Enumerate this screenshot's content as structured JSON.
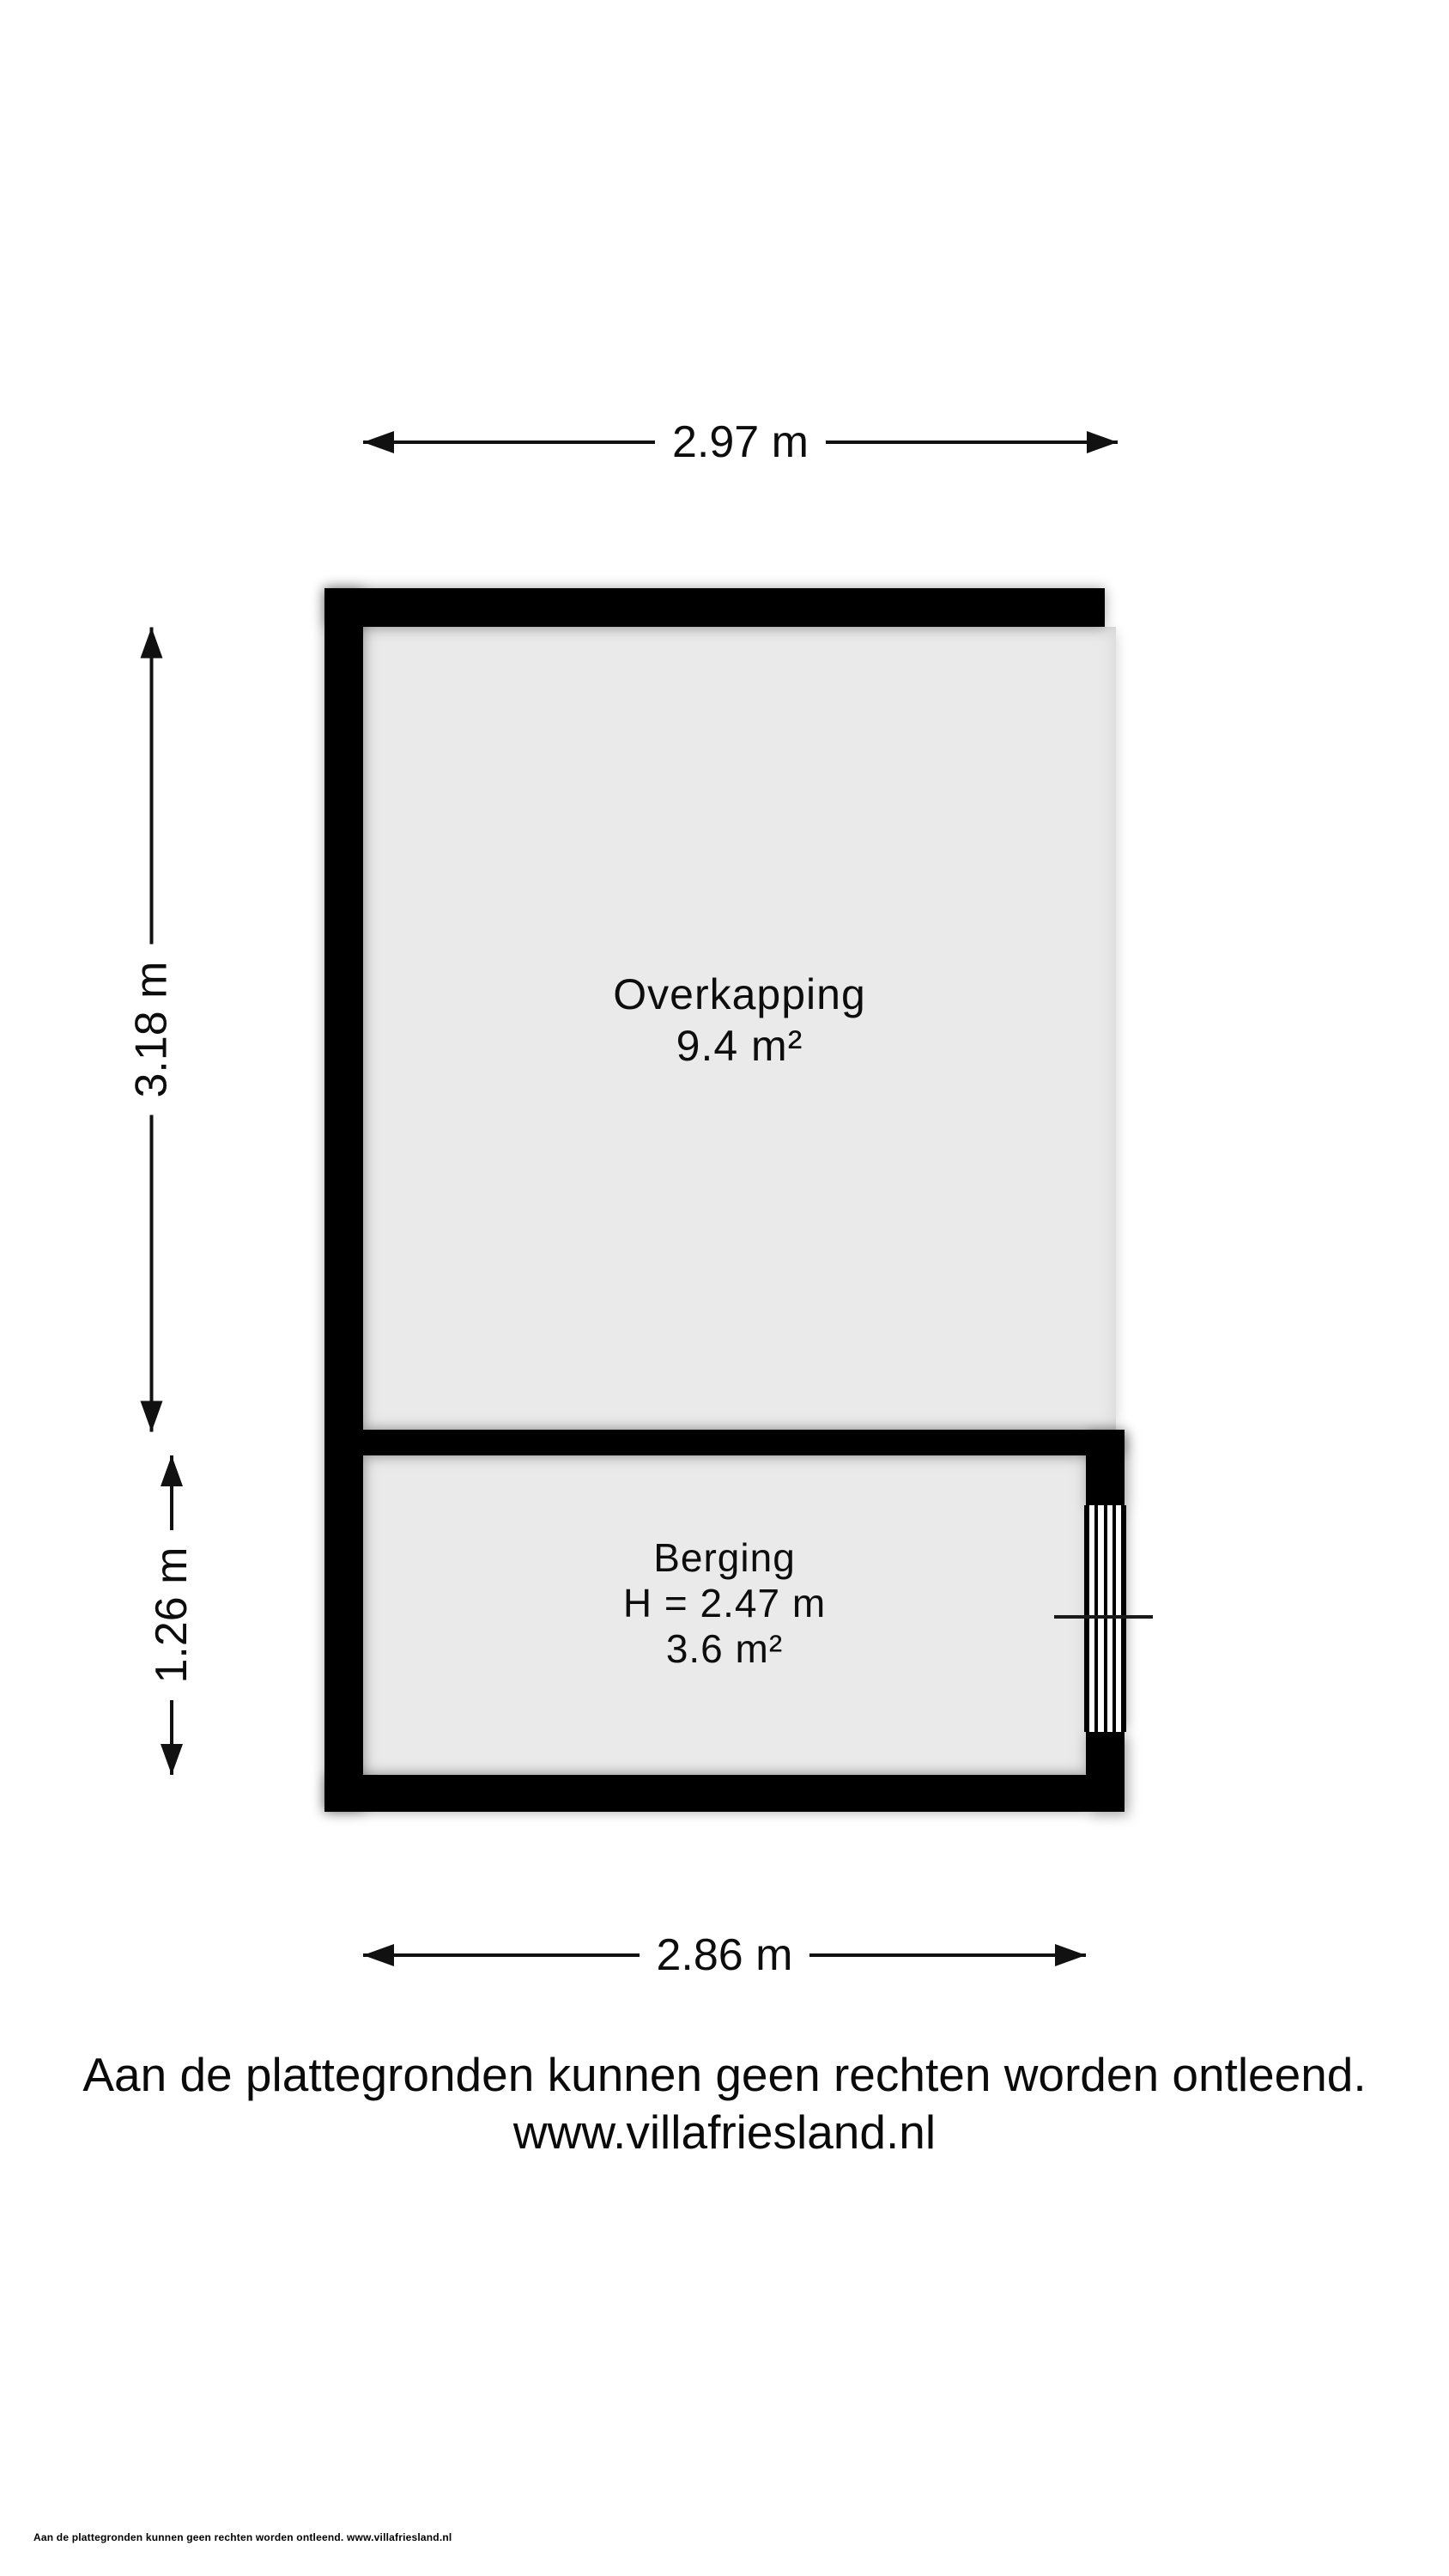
{
  "colors": {
    "background": "#ffffff",
    "wall": "#000000",
    "floor": "#eaeaea",
    "text": "#000000"
  },
  "dimensions": {
    "top": "2.97 m",
    "left_upper": "3.18 m",
    "left_lower": "1.26 m",
    "bottom": "2.86 m"
  },
  "rooms": {
    "overkapping": {
      "name": "Overkapping",
      "area": "9.4 m²"
    },
    "berging": {
      "name": "Berging",
      "ceiling_height": "H = 2.47 m",
      "area": "3.6 m²"
    }
  },
  "disclaimer": {
    "line1": "Aan de plattegronden kunnen geen rechten worden ontleend.",
    "line2": "www.villafriesland.nl"
  },
  "footer": "Aan de plattegronden kunnen geen rechten worden ontleend. www.villafriesland.nl"
}
